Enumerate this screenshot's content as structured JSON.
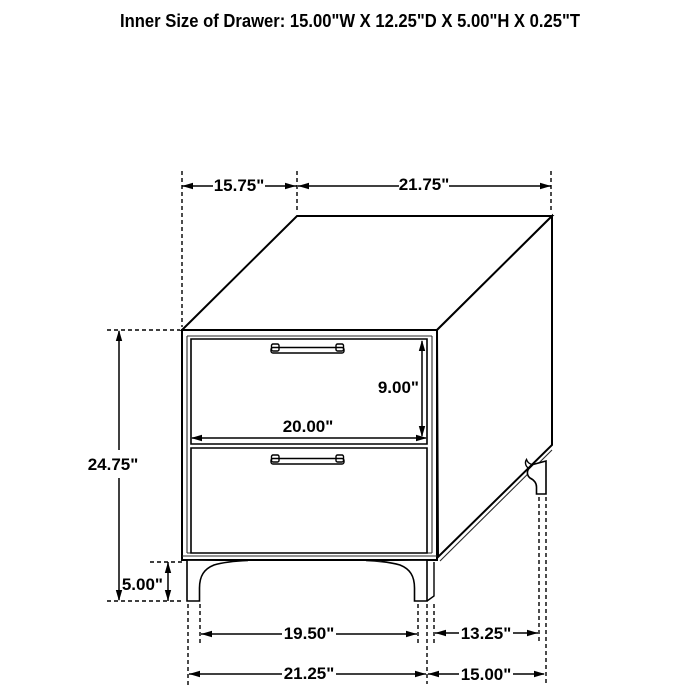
{
  "title": "Inner Size of Drawer: 15.00\"W X 12.25\"D X 5.00\"H X 0.25\"T",
  "dims": {
    "top_depth": "15.75\"",
    "top_width": "21.75\"",
    "overall_height": "24.75\"",
    "drawer_opening_height": "9.00\"",
    "drawer_front_width": "20.00\"",
    "leg_height": "5.00\"",
    "front_leg_spacing": "19.50\"",
    "side_leg_spacing": "13.25\"",
    "overall_width": "21.25\"",
    "overall_depth": "15.00\""
  },
  "colors": {
    "line": "#000000",
    "text": "#000000",
    "background": "#ffffff"
  }
}
